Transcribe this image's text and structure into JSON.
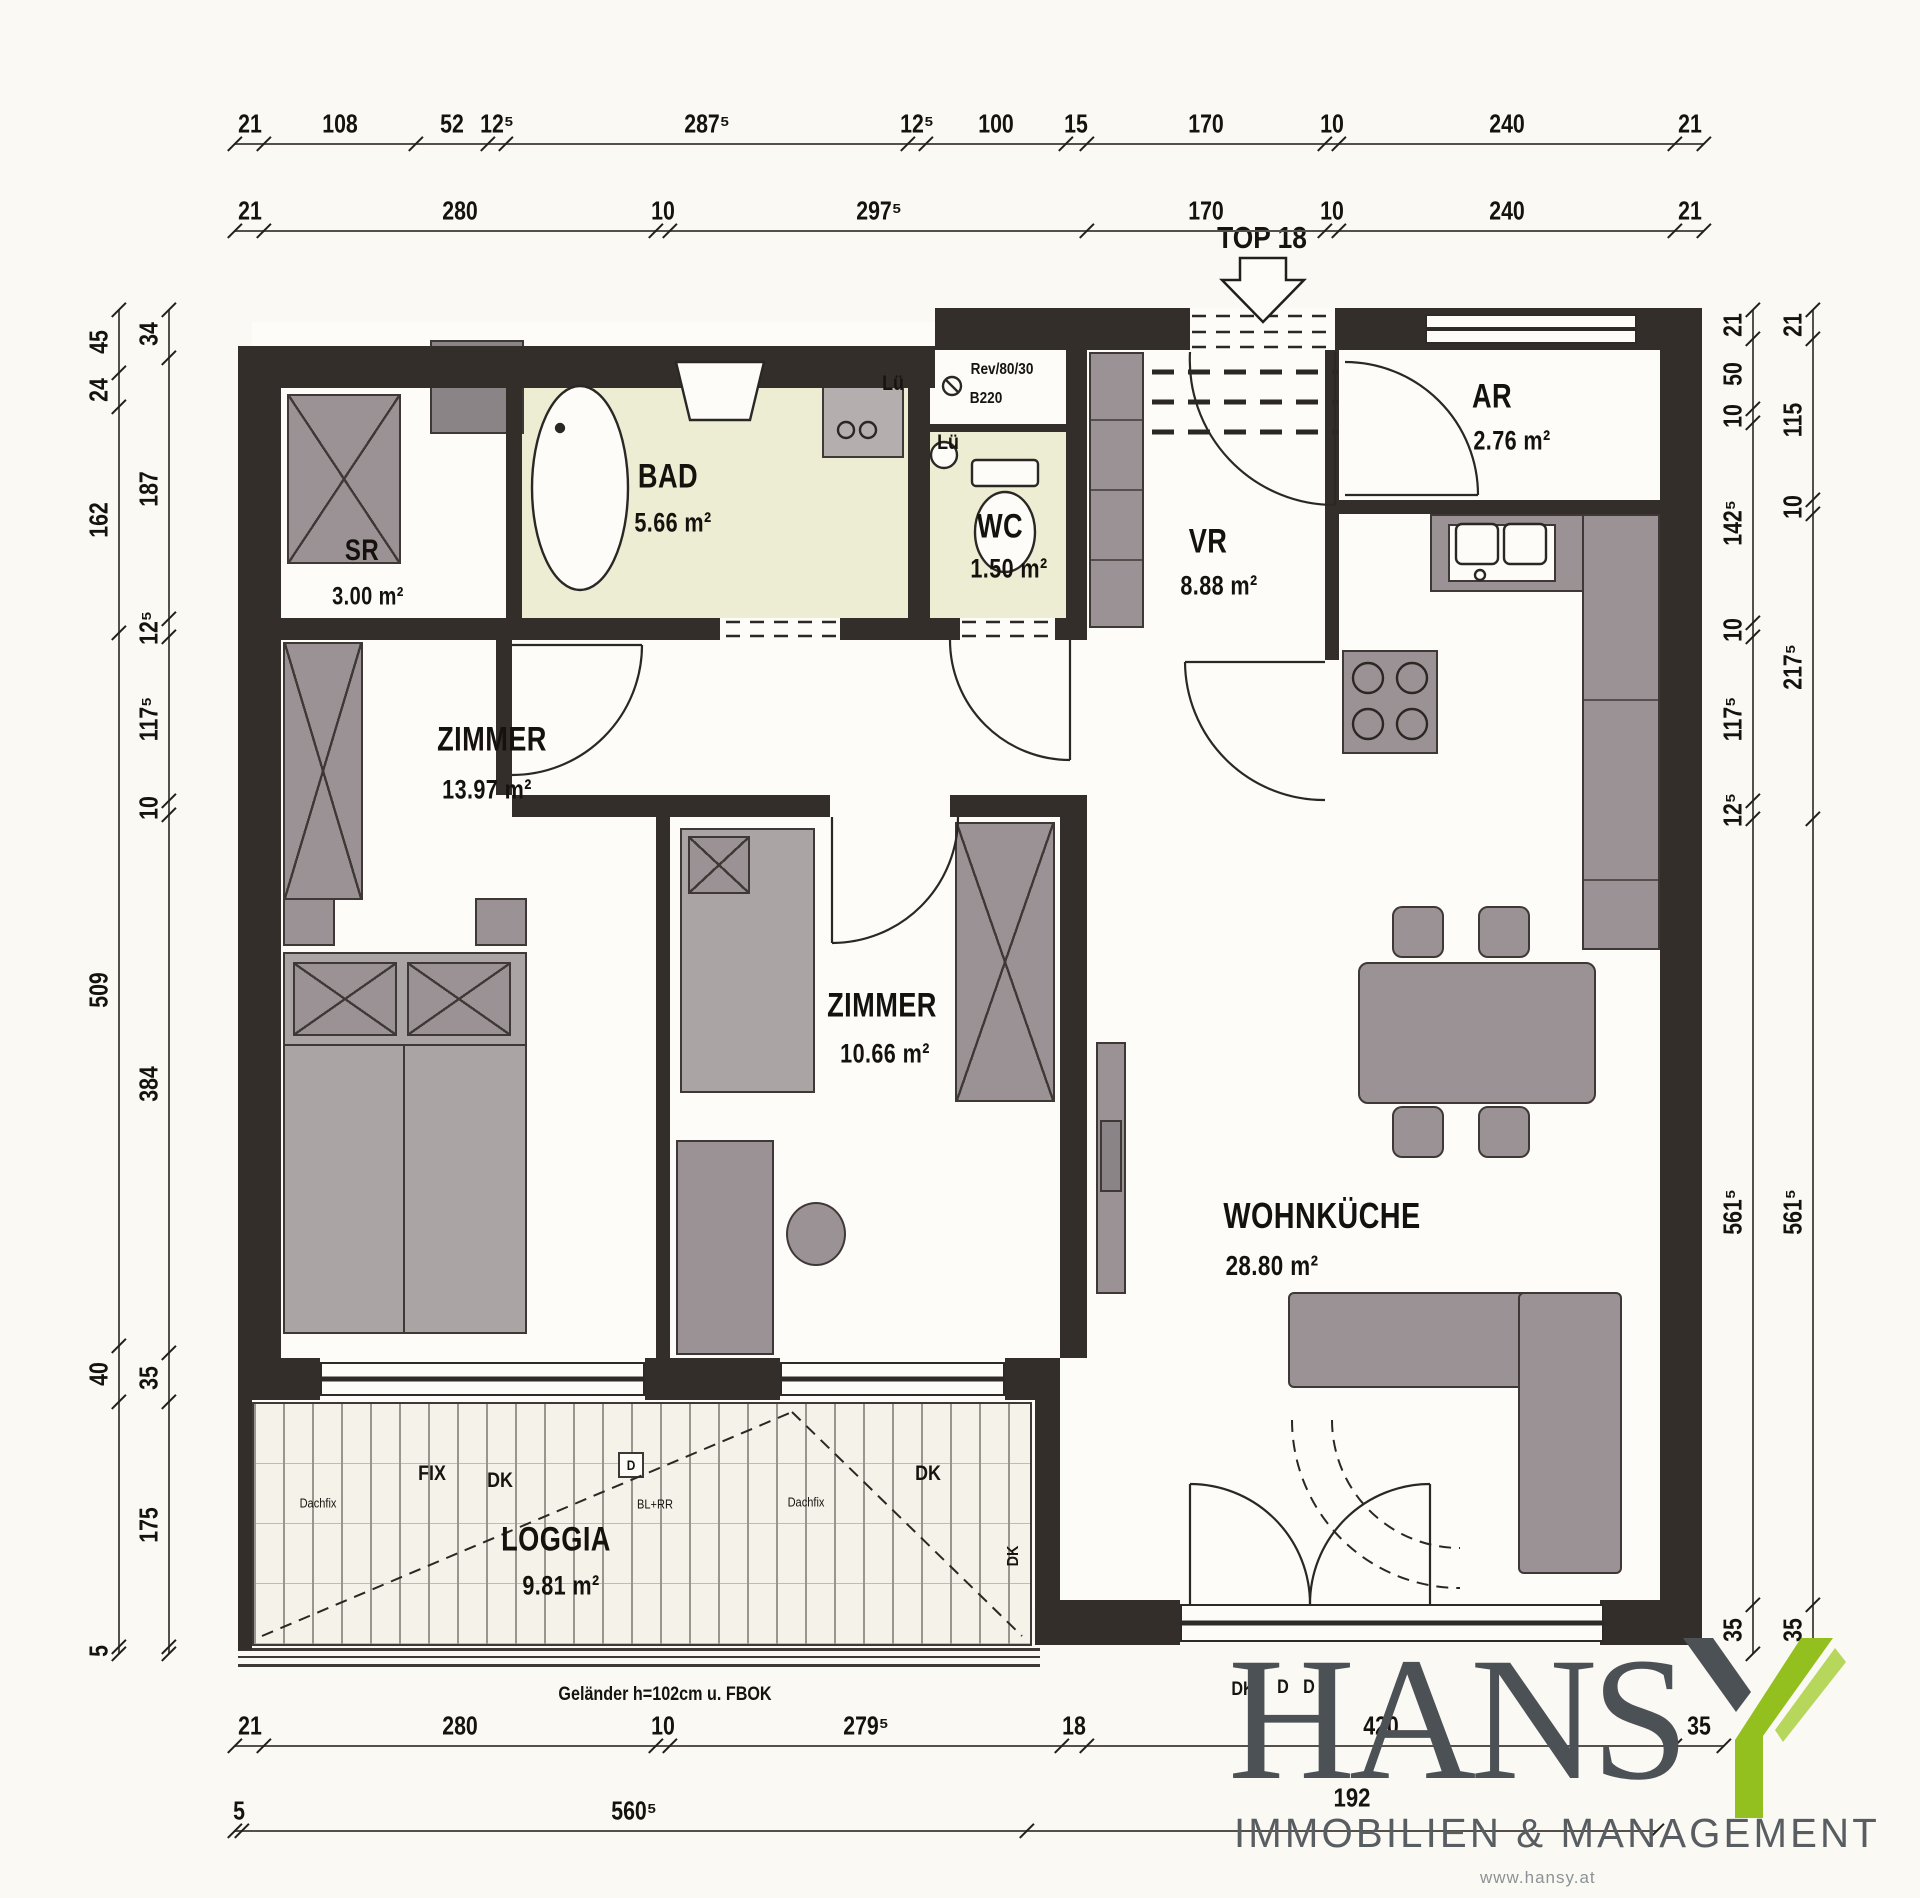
{
  "plan": {
    "top_label": "TOP 18",
    "note_railing": "Geländer h=102cm u. FBOK",
    "rooms": [
      {
        "name": "SR",
        "area": "3.00 m²",
        "nx": 362,
        "ny": 551,
        "ax": 368,
        "ay": 597,
        "ns": 30,
        "as": 25
      },
      {
        "name": "BAD",
        "area": "5.66 m²",
        "nx": 668,
        "ny": 477,
        "ax": 673,
        "ay": 523,
        "ns": 34,
        "as": 27
      },
      {
        "name": "WC",
        "area": "1.50 m²",
        "nx": 1000,
        "ny": 527,
        "ax": 1009,
        "ay": 569,
        "ns": 34,
        "as": 27
      },
      {
        "name": "VR",
        "area": "8.88 m²",
        "nx": 1208,
        "ny": 542,
        "ax": 1219,
        "ay": 586,
        "ns": 34,
        "as": 27
      },
      {
        "name": "AR",
        "area": "2.76 m²",
        "nx": 1492,
        "ny": 397,
        "ax": 1512,
        "ay": 441,
        "ns": 34,
        "as": 27
      },
      {
        "name": "ZIMMER",
        "area": "13.97 m²",
        "nx": 492,
        "ny": 740,
        "ax": 487,
        "ay": 790,
        "ns": 34,
        "as": 27
      },
      {
        "name": "ZIMMER",
        "area": "10.66 m²",
        "nx": 882,
        "ny": 1006,
        "ax": 885,
        "ay": 1054,
        "ns": 34,
        "as": 27
      },
      {
        "name": "WOHNKÜCHE",
        "area": "28.80 m²",
        "nx": 1322,
        "ny": 1216,
        "ax": 1272,
        "ay": 1266,
        "ns": 36,
        "as": 28
      },
      {
        "name": "LOGGIA",
        "area": "9.81 m²",
        "nx": 556,
        "ny": 1540,
        "ax": 561,
        "ay": 1586,
        "ns": 34,
        "as": 27
      }
    ],
    "annotations": [
      {
        "text": "Lü",
        "x": 893,
        "y": 384,
        "size": 21,
        "bold": true
      },
      {
        "text": "Lü",
        "x": 948,
        "y": 443,
        "size": 21,
        "bold": true
      },
      {
        "text": "Rev/80/30",
        "x": 1002,
        "y": 370,
        "size": 16,
        "bold": true
      },
      {
        "text": "B220",
        "x": 986,
        "y": 399,
        "size": 16,
        "bold": true
      },
      {
        "text": "Dachfix",
        "x": 318,
        "y": 1503,
        "size": 13,
        "bold": false
      },
      {
        "text": "FIX",
        "x": 432,
        "y": 1474,
        "size": 21,
        "bold": true
      },
      {
        "text": "DK",
        "x": 500,
        "y": 1481,
        "size": 21,
        "bold": true
      },
      {
        "text": "D",
        "x": 631,
        "y": 1465,
        "size": 14,
        "bold": true
      },
      {
        "text": "BL+RR",
        "x": 655,
        "y": 1504,
        "size": 13,
        "bold": false
      },
      {
        "text": "Dachfix",
        "x": 806,
        "y": 1502,
        "size": 13,
        "bold": false
      },
      {
        "text": "DK",
        "x": 928,
        "y": 1474,
        "size": 21,
        "bold": true
      },
      {
        "text": "DK",
        "x": 1014,
        "y": 1556,
        "size": 16,
        "bold": true,
        "rot": true
      },
      {
        "text": "DK",
        "x": 1243,
        "y": 1690,
        "size": 19,
        "bold": true
      },
      {
        "text": "D",
        "x": 1283,
        "y": 1688,
        "size": 19,
        "bold": true
      },
      {
        "text": "D",
        "x": 1309,
        "y": 1688,
        "size": 19,
        "bold": true
      },
      {
        "text": "192",
        "x": 1352,
        "y": 1798,
        "size": 26,
        "bold": true
      }
    ]
  },
  "dimensions": {
    "chains": [
      {
        "id": "top-row-1",
        "orient": "h",
        "x0": 235,
        "y": 143,
        "segments": [
          {
            "label": "21",
            "cm": 21
          },
          {
            "label": "108",
            "cm": 108
          },
          {
            "label": "52",
            "cm": 52
          },
          {
            "label": "12⁵",
            "cm": 12.5
          },
          {
            "label": "287⁵",
            "cm": 287.5
          },
          {
            "label": "12⁵",
            "cm": 12.5
          },
          {
            "label": "100",
            "cm": 100
          },
          {
            "label": "15",
            "cm": 15
          },
          {
            "label": "170",
            "cm": 170
          },
          {
            "label": "10",
            "cm": 10
          },
          {
            "label": "240",
            "cm": 240
          },
          {
            "label": "21",
            "cm": 21
          }
        ]
      },
      {
        "id": "top-row-2",
        "orient": "h",
        "x0": 235,
        "y": 230,
        "segments": [
          {
            "label": "21",
            "cm": 21
          },
          {
            "label": "280",
            "cm": 280
          },
          {
            "label": "10",
            "cm": 10
          },
          {
            "label": "297⁵",
            "cm": 297.5
          },
          {
            "label": "170",
            "cm": 170
          },
          {
            "label": "10",
            "cm": 10
          },
          {
            "label": "240",
            "cm": 240
          },
          {
            "label": "21",
            "cm": 21
          }
        ]
      },
      {
        "id": "bottom-row-1",
        "orient": "h",
        "x0": 235,
        "y": 1745,
        "segments": [
          {
            "label": "21",
            "cm": 21
          },
          {
            "label": "280",
            "cm": 280
          },
          {
            "label": "10",
            "cm": 10
          },
          {
            "label": "279⁵",
            "cm": 279.5
          },
          {
            "label": "18",
            "cm": 18
          },
          {
            "label": "420",
            "cm": 420
          },
          {
            "label": "35",
            "cm": 35
          }
        ]
      },
      {
        "id": "bottom-row-2",
        "orient": "h",
        "x0": 235,
        "y": 1830,
        "segments": [
          {
            "label": "5",
            "cm": 5
          },
          {
            "label": "560⁵",
            "cm": 560.5
          },
          {
            "label": "",
            "cm": 450
          }
        ]
      },
      {
        "id": "left-outer",
        "orient": "v",
        "x": 118,
        "y0": 310,
        "segments": [
          {
            "label": "45",
            "cm": 45
          },
          {
            "label": "24",
            "cm": 24
          },
          {
            "label": "162",
            "cm": 162
          },
          {
            "label": "509",
            "cm": 509
          },
          {
            "label": "40",
            "cm": 40
          },
          {
            "label": "",
            "cm": 175
          },
          {
            "label": "5",
            "cm": 5
          }
        ]
      },
      {
        "id": "left-inner",
        "orient": "v",
        "x": 168,
        "y0": 310,
        "segments": [
          {
            "label": "34",
            "cm": 34
          },
          {
            "label": "187",
            "cm": 187
          },
          {
            "label": "12⁵",
            "cm": 12.5
          },
          {
            "label": "117⁵",
            "cm": 117.5
          },
          {
            "label": "10",
            "cm": 10
          },
          {
            "label": "384",
            "cm": 384
          },
          {
            "label": "35",
            "cm": 35
          },
          {
            "label": "175",
            "cm": 175
          },
          {
            "label": "",
            "cm": 5
          }
        ]
      },
      {
        "id": "right-inner",
        "orient": "v",
        "x": 1752,
        "y0": 310,
        "segments": [
          {
            "label": "21",
            "cm": 21
          },
          {
            "label": "50",
            "cm": 50
          },
          {
            "label": "10",
            "cm": 10
          },
          {
            "label": "142⁵",
            "cm": 142.5
          },
          {
            "label": "10",
            "cm": 10
          },
          {
            "label": "117⁵",
            "cm": 117.5
          },
          {
            "label": "12⁵",
            "cm": 12.5
          },
          {
            "label": "561⁵",
            "cm": 561.5
          },
          {
            "label": "35",
            "cm": 35
          }
        ]
      },
      {
        "id": "right-outer",
        "orient": "v",
        "x": 1812,
        "y0": 310,
        "segments": [
          {
            "label": "21",
            "cm": 21
          },
          {
            "label": "115",
            "cm": 115
          },
          {
            "label": "10",
            "cm": 10
          },
          {
            "label": "217⁵",
            "cm": 217.5
          },
          {
            "label": "561⁵",
            "cm": 561.5
          },
          {
            "label": "35",
            "cm": 35
          }
        ]
      }
    ],
    "scale_px_per_cm": 1.4
  },
  "logo": {
    "word_main": "HANS",
    "word_y": "Y",
    "subtitle": "IMMOBILIEN & MANAGEMENT",
    "website": "www.hansy.at"
  },
  "colors": {
    "wall": "#332e2a",
    "furniture": "#9a9294",
    "wet_room_tint": "#ecedd3",
    "logo_green": "#93c01f",
    "logo_gray": "#4c5156"
  }
}
